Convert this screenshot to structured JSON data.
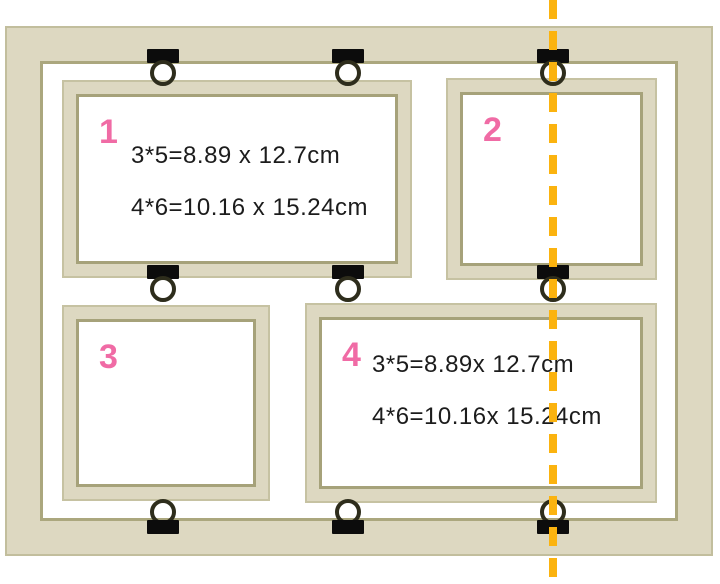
{
  "frames": [
    {
      "number": "1",
      "dims": [
        "3*5=8.89 x 12.7cm",
        "4*6=10.16 x 15.24cm"
      ]
    },
    {
      "number": "2",
      "dims": []
    },
    {
      "number": "3",
      "dims": []
    },
    {
      "number": "4",
      "dims": [
        "3*5=8.89x 12.7cm",
        "4*6=10.16x 15.24cm"
      ]
    }
  ],
  "colors": {
    "frame_fill": "#DDD8C1",
    "frame_edge_dark": "#A6A27A",
    "frame_edge_light": "#C6C2A2",
    "clip_bar": "#0C0C0C",
    "clip_ring": "#2E2D1C",
    "fold_line": "#FBB30F",
    "number_pink": "#F06BA5",
    "dimension_text": "#1C1C1C",
    "background": "#FFFFFF"
  }
}
